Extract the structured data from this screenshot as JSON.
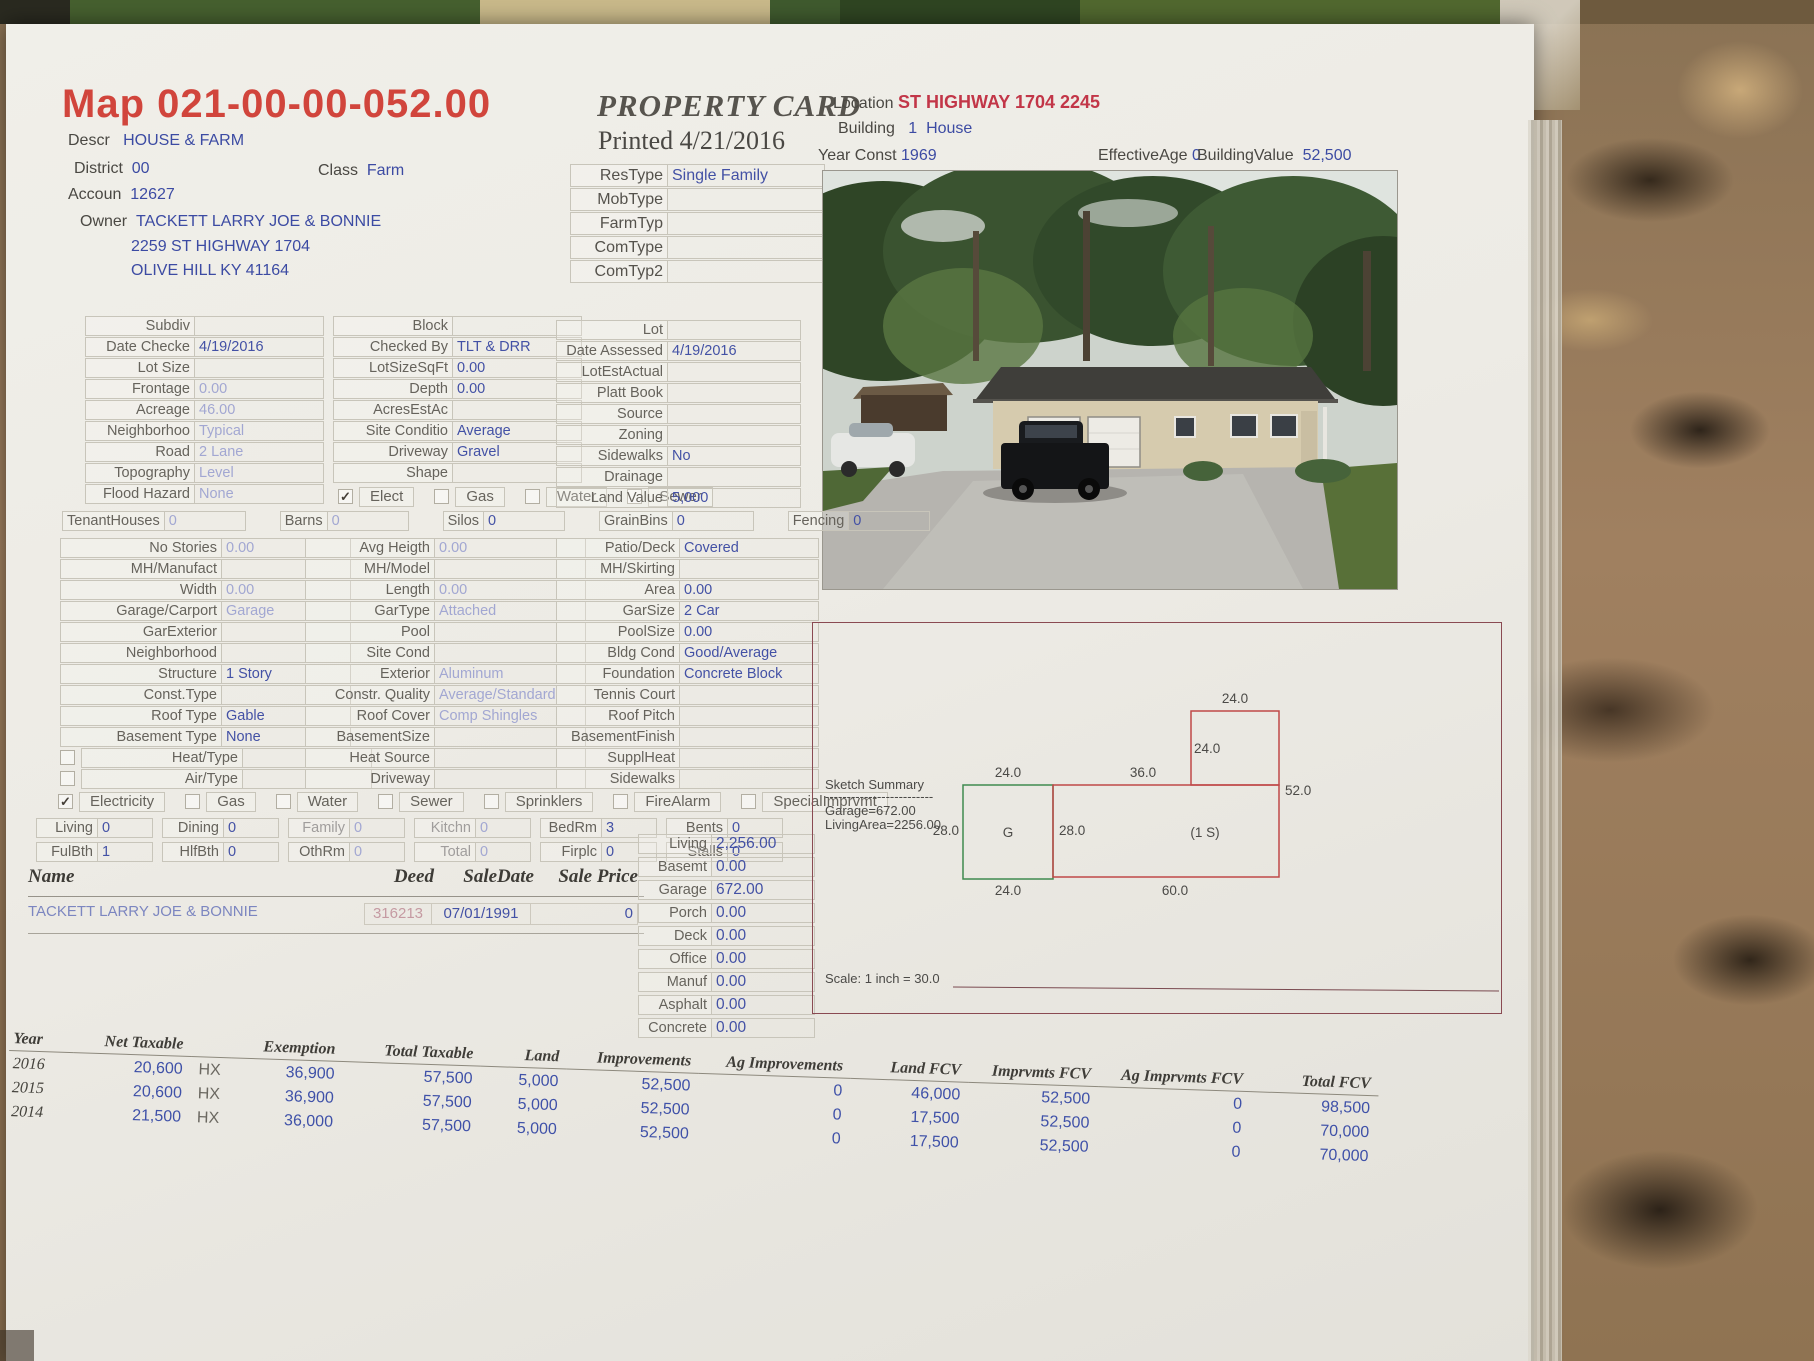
{
  "header": {
    "map_title": "Map 021-00-00-052.00",
    "descr_label": "Descr",
    "descr_value": "HOUSE & FARM",
    "district_label": "District",
    "district_value": "00",
    "class_label": "Class",
    "class_value": "Farm",
    "account_label": "Accoun",
    "account_value": "12627",
    "owner_label": "Owner",
    "owner_value": "TACKETT LARRY JOE & BONNIE",
    "owner_address1": "2259 ST HIGHWAY 1704",
    "owner_address2": "OLIVE HILL KY 41164",
    "card_title": "PROPERTY CARD",
    "printed_line": "Printed 4/21/2016",
    "location_label": "Location",
    "location_value": "ST HIGHWAY 1704 2245",
    "building_label": "Building",
    "building_value": "1  House",
    "year_const_label": "Year Const",
    "year_const_value": "1969",
    "effective_age_label": "EffectiveAge",
    "effective_age_value": "0",
    "building_value_label": "BuildingValue",
    "building_value_amount": "52,500"
  },
  "type_rows": [
    {
      "label": "ResType",
      "value": "Single Family"
    },
    {
      "label": "MobType",
      "value": ""
    },
    {
      "label": "FarmTyp",
      "value": ""
    },
    {
      "label": "ComType",
      "value": ""
    },
    {
      "label": "ComTyp2",
      "value": ""
    }
  ],
  "land_col1": [
    {
      "label": "Subdiv",
      "value": ""
    },
    {
      "label": "Date Checke",
      "value": "4/19/2016"
    },
    {
      "label": "Lot Size",
      "value": ""
    },
    {
      "label": "Frontage",
      "value": "0.00",
      "faint": true
    },
    {
      "label": "Acreage",
      "value": "46.00",
      "faint": true
    },
    {
      "label": "Neighborhoo",
      "value": "Typical",
      "faint": true
    },
    {
      "label": "Road",
      "value": "2 Lane",
      "faint": true
    },
    {
      "label": "Topography",
      "value": "Level",
      "faint": true
    },
    {
      "label": "Flood Hazard",
      "value": "None",
      "faint": true
    }
  ],
  "land_col2": [
    {
      "label": "Block",
      "value": ""
    },
    {
      "label": "Checked By",
      "value": "TLT & DRR"
    },
    {
      "label": "LotSizeSqFt",
      "value": "0.00"
    },
    {
      "label": "Depth",
      "value": "0.00"
    },
    {
      "label": "AcresEstAc",
      "value": ""
    },
    {
      "label": "Site Conditio",
      "value": "Average"
    },
    {
      "label": "Driveway",
      "value": "Gravel"
    },
    {
      "label": "Shape",
      "value": ""
    }
  ],
  "land_utilities": [
    {
      "label": "Elect",
      "checked": true
    },
    {
      "label": "Gas",
      "checked": false
    },
    {
      "label": "Water",
      "checked": false
    },
    {
      "label": "Sewer",
      "checked": false
    }
  ],
  "land_col3": [
    {
      "label": "Lot",
      "value": ""
    },
    {
      "label": "Date Assessed",
      "value": "4/19/2016"
    },
    {
      "label": "LotEstActual",
      "value": ""
    },
    {
      "label": "Platt Book",
      "value": ""
    },
    {
      "label": "Source",
      "value": ""
    },
    {
      "label": "Zoning",
      "value": ""
    },
    {
      "label": "Sidewalks",
      "value": "No"
    },
    {
      "label": "Drainage",
      "value": ""
    },
    {
      "label": "Land Value",
      "value": "5,000"
    }
  ],
  "farm_row": [
    {
      "label": "TenantHouses",
      "value": "0",
      "faint": true
    },
    {
      "label": "Barns",
      "value": "0",
      "faint": true
    },
    {
      "label": "Silos",
      "value": "0"
    },
    {
      "label": "GrainBins",
      "value": "0"
    },
    {
      "label": "Fencing",
      "value": "0"
    }
  ],
  "bld_col1": [
    {
      "label": "No Stories",
      "value": "0.00",
      "faint": true
    },
    {
      "label": "MH/Manufact",
      "value": ""
    },
    {
      "label": "Width",
      "value": "0.00",
      "faint": true
    },
    {
      "label": "Garage/Carport",
      "value": "Garage",
      "faint": true
    },
    {
      "label": "GarExterior",
      "value": ""
    },
    {
      "label": "Neighborhood",
      "value": ""
    },
    {
      "label": "Structure",
      "value": "1 Story"
    },
    {
      "label": "Const.Type",
      "value": ""
    },
    {
      "label": "Roof Type",
      "value": "Gable"
    },
    {
      "label": "Basement Type",
      "value": "None"
    },
    {
      "label": "Heat/Type",
      "value": "",
      "checkbox": false
    },
    {
      "label": "Air/Type",
      "value": "",
      "checkbox": false
    }
  ],
  "bld_col2": [
    {
      "label": "Avg Heigth",
      "value": "0.00",
      "faint": true
    },
    {
      "label": "MH/Model",
      "value": ""
    },
    {
      "label": "Length",
      "value": "0.00",
      "faint": true
    },
    {
      "label": "GarType",
      "value": "Attached",
      "faint": true
    },
    {
      "label": "Pool",
      "value": ""
    },
    {
      "label": "Site Cond",
      "value": ""
    },
    {
      "label": "Exterior",
      "value": "Aluminum",
      "faint": true
    },
    {
      "label": "Constr. Quality",
      "value": "Average/Standard",
      "faint": true
    },
    {
      "label": "Roof Cover",
      "value": "Comp Shingles",
      "faint": true
    },
    {
      "label": "BasementSize",
      "value": ""
    },
    {
      "label": "Heat Source",
      "value": ""
    },
    {
      "label": "Driveway",
      "value": ""
    }
  ],
  "bld_col3": [
    {
      "label": "Patio/Deck",
      "value": "Covered"
    },
    {
      "label": "MH/Skirting",
      "value": ""
    },
    {
      "label": "Area",
      "value": "0.00"
    },
    {
      "label": "GarSize",
      "value": "2 Car"
    },
    {
      "label": "PoolSize",
      "value": "0.00"
    },
    {
      "label": "Bldg Cond",
      "value": "Good/Average"
    },
    {
      "label": "Foundation",
      "value": "Concrete Block"
    },
    {
      "label": "Tennis Court",
      "value": ""
    },
    {
      "label": "Roof Pitch",
      "value": ""
    },
    {
      "label": "BasementFinish",
      "value": ""
    },
    {
      "label": "SupplHeat",
      "value": ""
    },
    {
      "label": "Sidewalks",
      "value": ""
    }
  ],
  "utilities": [
    {
      "label": "Electricity",
      "checked": true
    },
    {
      "label": "Gas",
      "checked": false
    },
    {
      "label": "Water",
      "checked": false
    },
    {
      "label": "Sewer",
      "checked": false,
      "faint_label": true
    },
    {
      "label": "Sprinklers",
      "checked": false,
      "faint_label": true
    },
    {
      "label": "FireAlarm",
      "checked": false
    },
    {
      "label": "SpecialImprvmt",
      "checked": false
    }
  ],
  "rooms_row1": [
    {
      "label": "Living",
      "value": "0"
    },
    {
      "label": "Dining",
      "value": "0"
    },
    {
      "label": "Family",
      "value": "0",
      "faint": true,
      "faint_label": true
    },
    {
      "label": "Kitchn",
      "value": "0",
      "faint": true,
      "faint_label": true
    },
    {
      "label": "BedRm",
      "value": "3"
    },
    {
      "label": "Bents",
      "value": "0"
    }
  ],
  "rooms_row2": [
    {
      "label": "FulBth",
      "value": "1"
    },
    {
      "label": "HlfBth",
      "value": "0"
    },
    {
      "label": "OthRm",
      "value": "0",
      "faint": true
    },
    {
      "label": "Total",
      "value": "0",
      "faint": true,
      "faint_label": true
    },
    {
      "label": "Firplc",
      "value": "0"
    },
    {
      "label": "Stalls",
      "value": "0"
    }
  ],
  "sales": {
    "name_header": "Name",
    "deed_header": "Deed",
    "date_header": "SaleDate",
    "price_header": "Sale Price",
    "row_name": "TACKETT LARRY JOE & BONNIE",
    "row_deed": "316213",
    "row_date": "07/01/1991",
    "row_price": "0"
  },
  "areas": [
    {
      "label": "Living",
      "value": "2,256.00"
    },
    {
      "label": "Basemt",
      "value": "0.00"
    },
    {
      "label": "Garage",
      "value": "672.00"
    },
    {
      "label": "Porch",
      "value": "0.00"
    },
    {
      "label": "Deck",
      "value": "0.00"
    },
    {
      "label": "Office",
      "value": "0.00"
    },
    {
      "label": "Manuf",
      "value": "0.00"
    },
    {
      "label": "Asphalt",
      "value": "0.00"
    },
    {
      "label": "Concrete",
      "value": "0.00"
    }
  ],
  "sketch": {
    "summary_title": "Sketch Summary",
    "summary_divider": "-------------------------",
    "garage_line": "Garage=672.00",
    "living_line": "LivingArea=2256.00",
    "scale_line": "Scale: 1 inch = 30.0",
    "dim_top": "24.0",
    "dim_upper_left": "24.0",
    "dim_green_top": "24.0",
    "dim_main_top": "36.0",
    "dim_right": "52.0",
    "dim_green_left": "28.0",
    "garage_letter": "G",
    "dim_main_left": "28.0",
    "story_label": "(1 S)",
    "dim_bottom_green": "24.0",
    "dim_bottom_main": "60.0"
  },
  "tax_table": {
    "headers": [
      "Year",
      "Net Taxable",
      "",
      "Exemption",
      "Total Taxable",
      "Land",
      "Improvements",
      "Ag Improvements",
      "Land FCV",
      "Imprvmts FCV",
      "Ag Imprvmts FCV",
      "Total FCV"
    ],
    "rows": [
      [
        "2016",
        "20,600",
        "HX",
        "36,900",
        "57,500",
        "5,000",
        "52,500",
        "0",
        "46,000",
        "52,500",
        "0",
        "98,500"
      ],
      [
        "2015",
        "20,600",
        "HX",
        "36,900",
        "57,500",
        "5,000",
        "52,500",
        "0",
        "17,500",
        "52,500",
        "0",
        "70,000"
      ],
      [
        "2014",
        "21,500",
        "HX",
        "36,000",
        "57,500",
        "5,000",
        "52,500",
        "0",
        "17,500",
        "52,500",
        "0",
        "70,000"
      ]
    ]
  }
}
